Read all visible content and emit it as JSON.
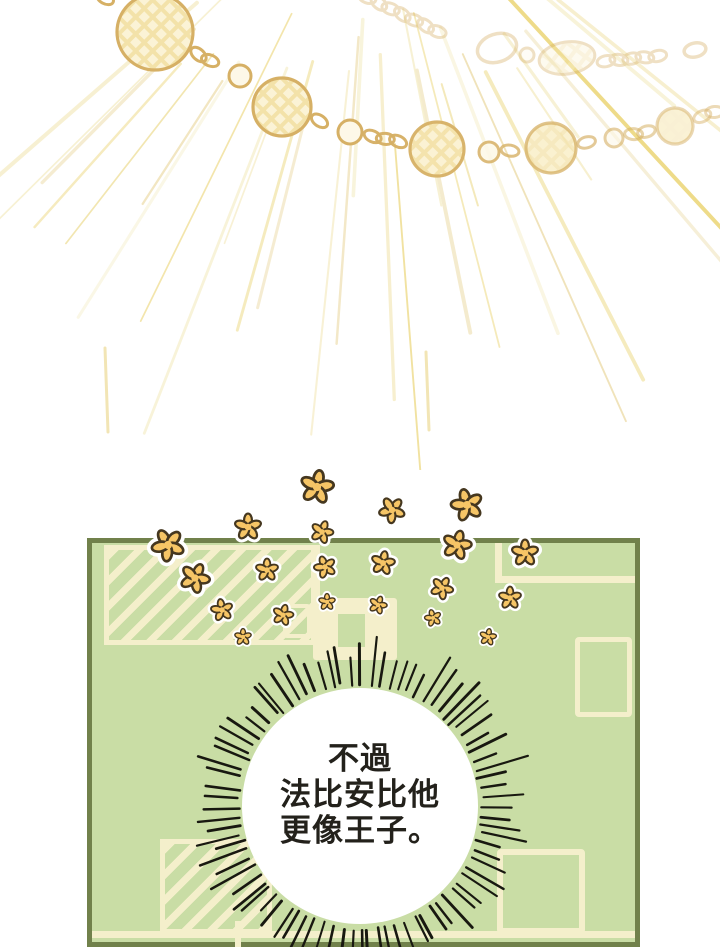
{
  "page": {
    "background": "#ffffff"
  },
  "speech_bubble": {
    "lines": [
      "不過",
      "法比安比他",
      "更像王子。"
    ],
    "fill": "#ffffff",
    "spike_color": "#181810",
    "text_color": "#23211b"
  },
  "panel": {
    "background": "#c9dda5",
    "border_color": "#71814b",
    "detail_color": "#f4efcb"
  },
  "artwork": {
    "rays": {
      "origin_x": 372,
      "origin_y": -150,
      "count": 30,
      "angle_start": 38,
      "angle_end": 142,
      "palette": [
        "#f6efcc",
        "#f1e3a8",
        "#ecd678",
        "#efe0b2"
      ],
      "extra": [
        {
          "x": 105,
          "y1": 348,
          "y2": 432
        },
        {
          "x": 426,
          "y1": 352,
          "y2": 430
        }
      ]
    },
    "necklace": {
      "gold": "#d6b065",
      "bead_fill": "#f3e2a9",
      "lattice": "#fbf3d6",
      "main_nodes": [
        {
          "x": 96,
          "y": -8,
          "r": 0,
          "o": 1
        },
        {
          "x": 155,
          "y": 32,
          "r": 38,
          "o": 1,
          "bead": true
        },
        {
          "x": 240,
          "y": 76,
          "r": 11,
          "o": 1,
          "small": true
        },
        {
          "x": 282,
          "y": 107,
          "r": 29,
          "o": 1,
          "bead": true
        },
        {
          "x": 350,
          "y": 132,
          "r": 12,
          "o": 1,
          "small": true
        },
        {
          "x": 437,
          "y": 149,
          "r": 27,
          "o": 0.95,
          "bead": true
        },
        {
          "x": 489,
          "y": 152,
          "r": 10,
          "o": 0.85,
          "small": true
        },
        {
          "x": 551,
          "y": 148,
          "r": 25,
          "o": 0.75,
          "bead": true
        },
        {
          "x": 614,
          "y": 138,
          "r": 9,
          "o": 0.6,
          "small": true
        },
        {
          "x": 675,
          "y": 126,
          "r": 18,
          "o": 0.5,
          "bead": true
        },
        {
          "x": 726,
          "y": 108,
          "r": 0,
          "o": 0.45
        }
      ],
      "upper_opacity": 0.38,
      "upper": [
        {
          "type": "links",
          "x1": 360,
          "y1": -6,
          "x2": 455,
          "y2": 40
        },
        {
          "type": "ring",
          "x": 497,
          "y": 48,
          "rx": 20,
          "ry": 14,
          "rot": -18
        },
        {
          "type": "small",
          "x": 527,
          "y": 55,
          "r": 7
        },
        {
          "type": "bead",
          "x": 567,
          "y": 58,
          "rx": 28,
          "ry": 16,
          "rot": -8
        },
        {
          "type": "links",
          "x1": 598,
          "y1": 62,
          "x2": 668,
          "y2": 55
        },
        {
          "type": "ring",
          "x": 695,
          "y": 50,
          "rx": 11,
          "ry": 7,
          "rot": -12
        }
      ]
    },
    "bubble": {
      "cx": 360,
      "cy": 806,
      "r": 118,
      "spikes": 84,
      "spike_min": 22,
      "spike_max": 46
    },
    "flowers": {
      "fill": "#f6c566",
      "stroke": "#45371f",
      "halo": "#ffffff",
      "items": [
        {
          "x": 317,
          "y": 487,
          "s": 1.15,
          "r": 10
        },
        {
          "x": 392,
          "y": 510,
          "s": 0.9,
          "r": 40
        },
        {
          "x": 467,
          "y": 505,
          "s": 1.1,
          "r": -15
        },
        {
          "x": 248,
          "y": 527,
          "s": 0.92,
          "r": 0
        },
        {
          "x": 322,
          "y": 532,
          "s": 0.78,
          "r": 20
        },
        {
          "x": 168,
          "y": 545,
          "s": 1.12,
          "r": -30
        },
        {
          "x": 457,
          "y": 545,
          "s": 1.0,
          "r": 15
        },
        {
          "x": 525,
          "y": 553,
          "s": 0.92,
          "r": 0
        },
        {
          "x": 195,
          "y": 578,
          "s": 1.02,
          "r": 25
        },
        {
          "x": 267,
          "y": 570,
          "s": 0.78,
          "r": 0
        },
        {
          "x": 325,
          "y": 567,
          "s": 0.76,
          "r": -20
        },
        {
          "x": 383,
          "y": 563,
          "s": 0.82,
          "r": 10
        },
        {
          "x": 442,
          "y": 588,
          "s": 0.78,
          "r": 30
        },
        {
          "x": 510,
          "y": 598,
          "s": 0.78,
          "r": 0
        },
        {
          "x": 222,
          "y": 610,
          "s": 0.76,
          "r": -10
        },
        {
          "x": 283,
          "y": 615,
          "s": 0.72,
          "r": 15
        },
        {
          "x": 327,
          "y": 602,
          "s": 0.58,
          "r": 0
        },
        {
          "x": 378,
          "y": 605,
          "s": 0.62,
          "r": 20
        },
        {
          "x": 433,
          "y": 618,
          "s": 0.58,
          "r": -15
        },
        {
          "x": 488,
          "y": 637,
          "s": 0.58,
          "r": 10
        },
        {
          "x": 243,
          "y": 637,
          "s": 0.58,
          "r": 0
        }
      ]
    }
  }
}
